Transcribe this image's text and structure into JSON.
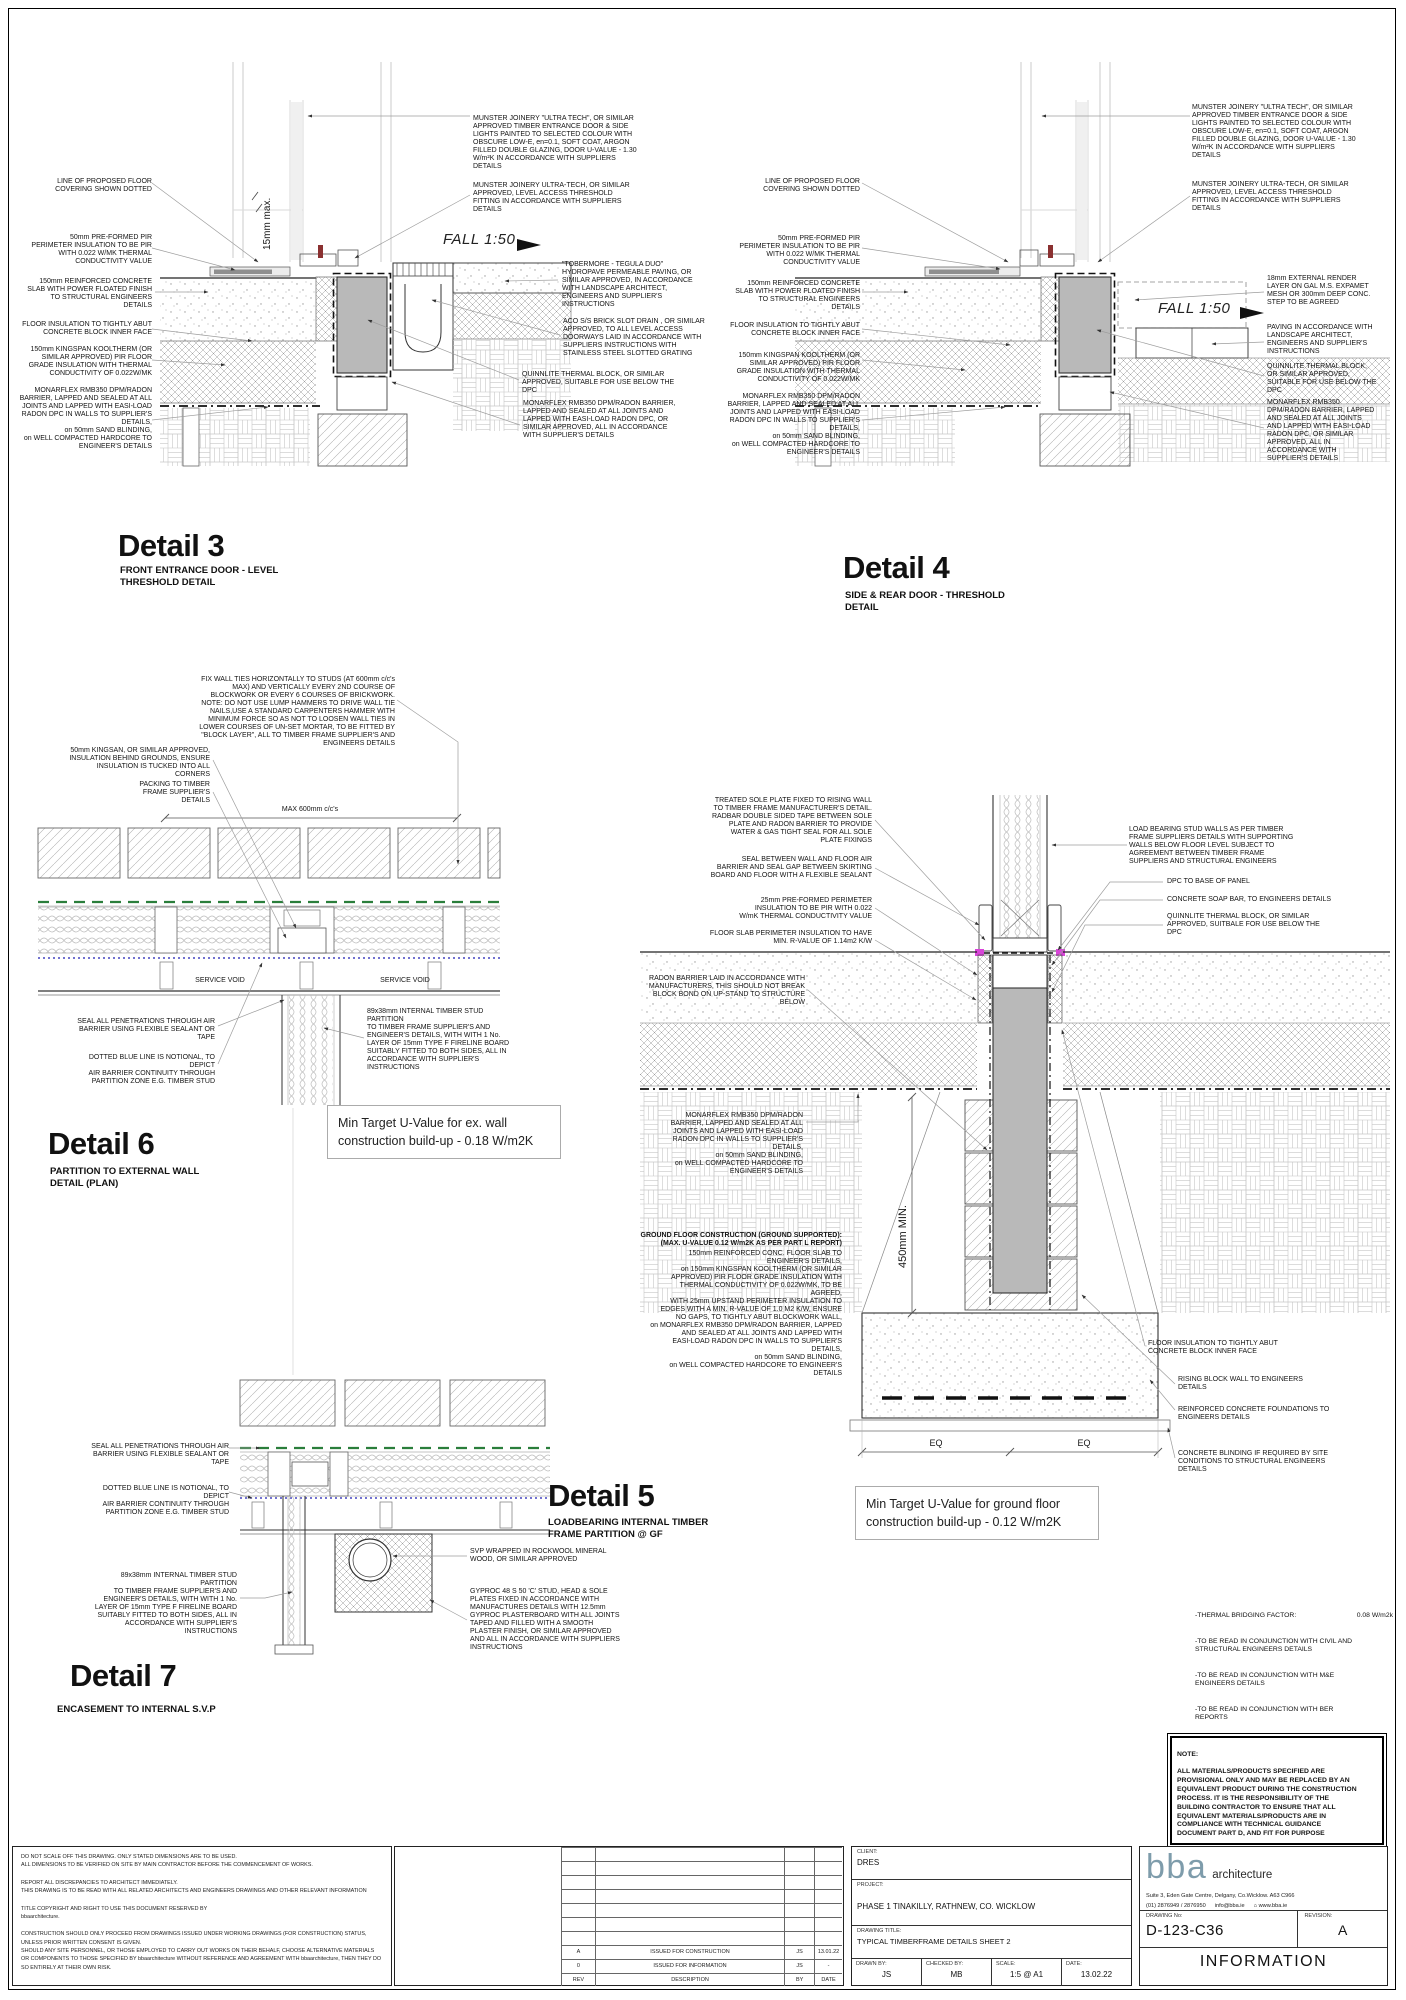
{
  "colors": {
    "air_barrier_green": "#2a7e3b",
    "air_barrier_blue": "#4343c0",
    "dpc_magenta": "#d944d9",
    "block_grey": "#b9b9b9",
    "logo_teal": "#7e9cab"
  },
  "details": {
    "d3": {
      "title": "Detail 3",
      "subtitle": "FRONT ENTRANCE DOOR - LEVEL\nTHRESHOLD DETAIL",
      "fall": "FALL 1:50",
      "dim15": "15mm max.",
      "left": [
        "LINE OF PROPOSED FLOOR\nCOVERING SHOWN DOTTED",
        "50mm PRE-FORMED  PIR\nPERIMETER INSULATION TO BE PIR\nWITH 0.022 W/MK THERMAL\nCONDUCTIVITY VALUE",
        "150mm REINFORCED CONCRETE\nSLAB WITH POWER FLOATED FINISH\nTO STRUCTURAL ENGINEERS\nDETAILS",
        "FLOOR INSULATION TO TIGHTLY ABUT\nCONCRETE BLOCK INNER FACE",
        "150mm KINGSPAN KOOLTHERM (OR\nSIMILAR APPROVED) PIR FLOOR\nGRADE INSULATION WITH THERMAL\nCONDUCTIVITY OF 0.022W/MK",
        "MONARFLEX RMB350 DPM/RADON\nBARRIER, LAPPED AND SEALED AT ALL\nJOINTS AND LAPPED WITH EASI-LOAD\nRADON DPC IN WALLS TO SUPPLIER'S\nDETAILS,\non 50mm SAND BLINDING,\non WELL COMPACTED HARDCORE TO\nENGINEER'S DETAILS"
      ],
      "right": [
        "MUNSTER JOINERY \"ULTRA TECH\", OR SIMILAR\nAPPROVED TIMBER ENTRANCE DOOR & SIDE\nLIGHTS PAINTED TO SELECTED COLOUR WITH\nOBSCURE LOW-E, en=0.1, SOFT COAT, ARGON\nFILLED DOUBLE GLAZING, DOOR U-VALUE - 1.30\nW/m²K IN ACCORDANCE WITH SUPPLIERS\nDETAILS",
        "MUNSTER JOINERY ULTRA-TECH, OR SIMILAR\nAPPROVED, LEVEL ACCESS THRESHOLD\nFITTING IN ACCORDANCE WITH SUPPLIERS\nDETAILS",
        "\"TOBERMORE - TEGULA DUO\"\nHYDROPAVE PERMEABLE PAVING, OR\nSIMILAR APPROVED, IN ACCORDANCE\nWITH LANDSCAPE ARCHITECT,\nENGINEERS AND SUPPLIER'S\nINSTRUCTIONS",
        "ACO S/S BRICK SLOT DRAIN , OR SIMILAR\nAPPROVED, TO ALL LEVEL ACCESS\nDOORWAYS LAID IN ACCORDANCE WITH\nSUPPLIERS INSTRUCTIONS WITH\nSTAINLESS STEEL SLOTTED GRATING",
        "QUINNLITE THERMAL BLOCK, OR SIMILAR\nAPPROVED, SUITABLE FOR USE BELOW THE\nDPC",
        "MONARFLEX RMB350 DPM/RADON BARRIER,\nLAPPED AND SEALED AT ALL JOINTS AND\nLAPPED WITH EASI-LOAD RADON DPC, OR\nSIMILAR APPROVED, ALL IN ACCORDANCE\nWITH SUPPLIER'S DETAILS"
      ]
    },
    "d4": {
      "title": "Detail 4",
      "subtitle": "SIDE & REAR DOOR - THRESHOLD\nDETAIL",
      "fall": "FALL 1:50",
      "left": [
        "LINE OF PROPOSED FLOOR\nCOVERING SHOWN DOTTED",
        "50mm PRE-FORMED  PIR\nPERIMETER INSULATION TO BE PIR\nWITH 0.022 W/MK THERMAL\nCONDUCTIVITY VALUE",
        "150mm REINFORCED CONCRETE\nSLAB WITH POWER FLOATED FINISH\nTO STRUCTURAL ENGINEERS\nDETAILS",
        "FLOOR INSULATION TO TIGHTLY ABUT\nCONCRETE BLOCK INNER FACE",
        "150mm KINGSPAN KOOLTHERM (OR\nSIMILAR APPROVED) PIR FLOOR\nGRADE INSULATION WITH THERMAL\nCONDUCTIVITY OF 0.022W/MK",
        "MONARFLEX RMB350 DPM/RADON\nBARRIER, LAPPED AND SEALED AT ALL\nJOINTS AND LAPPED WITH EASI-LOAD\nRADON DPC IN WALLS TO SUPPLIER'S\nDETAILS,\non 50mm SAND BLINDING,\non WELL COMPACTED HARDCORE TO\nENGINEER'S DETAILS"
      ],
      "right": [
        "MUNSTER JOINERY \"ULTRA TECH\", OR SIMILAR\nAPPROVED TIMBER ENTRANCE DOOR & SIDE\nLIGHTS PAINTED TO SELECTED COLOUR WITH\nOBSCURE LOW-E, en=0.1, SOFT COAT, ARGON\nFILLED DOUBLE GLAZING, DOOR U-VALUE - 1.30\nW/m²K IN ACCORDANCE WITH SUPPLIERS\nDETAILS",
        "MUNSTER JOINERY ULTRA-TECH, OR SIMILAR\nAPPROVED, LEVEL ACCESS THRESHOLD\nFITTING IN ACCORDANCE WITH SUPPLIERS\nDETAILS",
        "18mm EXTERNAL RENDER\nLAYER ON GAL M.S. EXPAMET\nMESH OR 300mm DEEP CONC.\nSTEP TO BE AGREED",
        "PAVING IN ACCORDANCE WITH\nLANDSCAPE ARCHITECT,\nENGINEERS AND SUPPLIER'S\nINSTRUCTIONS",
        "QUINNLITE THERMAL BLOCK,\nOR SIMILAR APPROVED,\nSUITABLE FOR USE BELOW THE\nDPC",
        "MONARFLEX RMB350\nDPM/RADON BARRIER, LAPPED\nAND SEALED AT ALL JOINTS\nAND LAPPED WITH EASI-LOAD\nRADON DPC, OR SIMILAR\nAPPROVED, ALL IN\nACCORDANCE WITH\nSUPPLIER'S DETAILS"
      ]
    },
    "d6": {
      "title": "Detail 6",
      "subtitle": "PARTITION TO EXTERNAL WALL\nDETAIL (PLAN)",
      "uvalue": "Min Target U-Value for ex. wall\nconstruction build-up - 0.18 W/m2K",
      "dim600": "MAX 600mm c/c's",
      "service": "SERVICE VOID",
      "ann": [
        "FIX WALL TIES HORIZONTALLY TO STUDS (AT 600mm c/c's\nMAX) AND VERTICALLY EVERY 2ND COURSE OF\nBLOCKWORK OR EVERY 6 COURSES OF BRICKWORK.\nNOTE: DO NOT USE LUMP HAMMERS TO DRIVE WALL TIE\nNAILS,USE A STANDARD CARPENTERS HAMMER WITH\nMINIMUM FORCE SO AS NOT TO LOOSEN WALL TIES IN\nLOWER COURSES OF UN-SET MORTAR, TO BE FITTED BY\n\"BLOCK LAYER\", ALL TO TIMBER FRAME SUPPLIER'S AND\nENGINEERS DETAILS",
        "50mm KINGSAN, OR SIMILAR APPROVED,\nINSULATION BEHIND GROUNDS, ENSURE\nINSULATION IS TUCKED INTO ALL CORNERS",
        "PACKING TO TIMBER\nFRAME SUPPLIER'S\nDETAILS",
        "SEAL ALL PENETRATIONS THROUGH AIR\nBARRIER USING FLEXIBLE SEALANT OR TAPE",
        "DOTTED BLUE LINE IS NOTIONAL, TO DEPICT\nAIR BARRIER CONTINUITY THROUGH\nPARTITION ZONE E.G. TIMBER STUD",
        "89x38mm INTERNAL TIMBER STUD PARTITION\nTO TIMBER FRAME SUPPLIER'S AND\nENGINEER'S DETAILS, WITH WITH 1 No.\nLAYER OF 15mm TYPE F FIRELINE BOARD\nSUITABLY FITTED TO BOTH SIDES, ALL IN\nACCORDANCE WITH SUPPLIER'S\nINSTRUCTIONS"
      ]
    },
    "d5": {
      "title": "Detail 5",
      "subtitle": "LOADBEARING INTERNAL TIMBER\nFRAME PARTITION @ GF",
      "uvalue": "Min Target U-Value for ground floor\nconstruction build-up - 0.12 W/m2K",
      "dim450": "450mm MIN.",
      "eq": "EQ",
      "left": [
        "TREATED SOLE PLATE FIXED TO RISING WALL\nTO TIMBER FRAME MANUFACTURER'S DETAIL.\nRADBAR DOUBLE SIDED TAPE BETWEEN SOLE\nPLATE AND RADON BARRIER TO PROVIDE\nWATER & GAS TIGHT SEAL FOR ALL SOLE\nPLATE FIXINGS",
        "SEAL BETWEEN WALL AND FLOOR AIR\nBARRIER AND SEAL GAP BETWEEN SKIRTING\nBOARD AND FLOOR WITH A FLEXIBLE SEALANT",
        "25mm PRE-FORMED PERIMETER\nINSULATION TO BE PIR WITH 0.022\nW/mK THERMAL CONDUCTIVITY VALUE",
        "FLOOR SLAB PERIMETER INSULATION TO HAVE\nMIN. R-VALUE OF 1.14m2 K/W",
        "RADON BARRIER LAID IN ACCORDANCE WITH\nMANUFACTURERS, THIS SHOULD NOT BREAK\nBLOCK BOND ON UP-STAND TO STRUCTURE\nBELOW",
        "MONARFLEX RMB350 DPM/RADON\nBARRIER, LAPPED AND SEALED AT ALL\nJOINTS AND LAPPED WITH EASI-LOAD\nRADON DPC IN WALLS TO SUPPLIER'S\nDETAILS,\non 50mm SAND BLINDING,\non WELL COMPACTED HARDCORE TO\nENGINEER'S DETAILS"
      ],
      "ground_header": "GROUND FLOOR CONSTRUCTION (GROUND SUPPORTED):\n(MAX. U-VALUE 0.12 W/m2K AS PER PART L REPORT)",
      "ground_body": "150mm REINFORCED CONC. FLOOR SLAB TO\nENGINEER'S DETAILS,\non 150mm KINGSPAN KOOLTHERM (OR SIMILAR\nAPPROVED) PIR FLOOR GRADE INSULATION WITH\nTHERMAL CONDUCTIVITY OF 0.022W/MK, TO BE\nAGREED,\nWITH 25mm UPSTAND PERIMETER INSULATION TO\nEDGES WITH A MIN. R-VALUE OF 1.0 M2 K/W, ENSURE\nNO GAPS, TO TIGHTLY ABUT BLOCKWORK WALL,\non MONARFLEX RMB350 DPM/RADON BARRIER, LAPPED\nAND SEALED AT ALL JOINTS AND LAPPED WITH\nEASI-LOAD RADON DPC IN WALLS TO SUPPLIER'S\nDETAILS,\non 50mm SAND BLINDING,\non WELL COMPACTED HARDCORE TO ENGINEER'S\nDETAILS",
      "right": [
        "LOAD BEARING STUD WALLS AS PER TIMBER\nFRAME SUPPLIERS DETAILS WITH SUPPORTING\nWALLS BELOW FLOOR LEVEL SUBJECT TO\nAGREEMENT BETWEEN TIMBER FRAME\nSUPPLIERS AND STRUCTURAL ENGINEERS",
        "DPC TO BASE OF PANEL",
        "CONCRETE SOAP BAR, TO ENGINEERS DETAILS",
        "QUINNLITE THERMAL BLOCK, OR SIMILAR\nAPPROVED, SUITBALE FOR USE BELOW THE\nDPC",
        "FLOOR INSULATION TO TIGHTLY ABUT\nCONCRETE BLOCK INNER FACE",
        "RISING BLOCK WALL TO ENGINEERS\nDETAILS",
        "REINFORCED CONCRETE FOUNDATIONS TO\nENGINEERS DETAILS",
        "CONCRETE BLINDING IF REQUIRED BY SITE\nCONDITIONS TO STRUCTURAL ENGINEERS\nDETAILS"
      ]
    },
    "d7": {
      "title": "Detail 7",
      "subtitle": "ENCASEMENT TO INTERNAL S.V.P",
      "ann": [
        "SEAL ALL PENETRATIONS THROUGH AIR\nBARRIER USING FLEXIBLE SEALANT OR TAPE",
        "DOTTED BLUE LINE IS NOTIONAL, TO DEPICT\nAIR BARRIER CONTINUITY THROUGH\nPARTITION ZONE E.G. TIMBER STUD",
        "89x38mm INTERNAL TIMBER STUD PARTITION\nTO TIMBER FRAME SUPPLIER'S AND\nENGINEER'S DETAILS, WITH WITH 1 No.\nLAYER OF 15mm TYPE F FIRELINE BOARD\nSUITABLY FITTED TO BOTH SIDES, ALL IN\nACCORDANCE WITH SUPPLIER'S\nINSTRUCTIONS",
        "SVP WRAPPED IN ROCKWOOL MINERAL\nWOOD, OR SIMILAR APPROVED",
        "GYPROC 48 S 50 'C' STUD, HEAD & SOLE\nPLATES FIXED IN ACCORDANCE WITH\nMANUFACTURES DETAILS WITH 12.5mm\nGYPROC PLASTERBOARD WITH ALL JOINTS\nTAPED AND FILLED WITH A SMOOTH\nPLASTER FINISH, OR SIMILAR APPROVED\nAND ALL IN ACCORDANCE WITH SUPPLIERS\nINSTRUCTIONS"
      ]
    }
  },
  "notes": {
    "thermal_label": "-THERMAL BRIDGING FACTOR:",
    "thermal_value": "0.08 W/m2k",
    "items": [
      "-TO BE READ IN CONJUNCTION WITH CIVIL AND\nSTRUCTURAL ENGINEERS DETAILS",
      "-TO BE READ IN CONJUNCTION WITH M&E\nENGINEERS DETAILS",
      "-TO BE READ IN CONJUNCTION WITH BER\nREPORTS"
    ],
    "note_title": "NOTE:",
    "note_body": " ALL MATERIALS/PRODUCTS SPECIFIED ARE\nPROVISIONAL ONLY AND MAY BE REPLACED BY AN\nEQUIVALENT PRODUCT DURING THE CONSTRUCTION\nPROCESS. IT IS THE RESPONSIBILITY OF THE\nBUILDING CONTRACTOR TO ENSURE THAT ALL\nEQUIVALENT MATERIALS/PRODUCTS ARE IN\nCOMPLIANCE WITH TECHNICAL GUIDANCE\nDOCUMENT PART D, AND FIT FOR PURPOSE"
  },
  "titleblock": {
    "disclaimer1": "DO NOT SCALE OFF THIS DRAWING. ONLY STATED DIMENSIONS ARE TO BE USED.\nALL DIMENSIONS TO BE VERIFIED ON SITE BY MAIN CONTRACTOR BEFORE THE COMMENCEMENT OF WORKS.",
    "disclaimer2": "REPORT ALL DISCREPANCIES TO ARCHITECT IMMEDIATELY.\nTHIS DRAWING IS TO BE READ WITH ALL RELATED ARCHITECTS AND ENGINEERS  DRAWINGS AND OTHER RELEVANT INFORMATION",
    "disclaimer3": "TITLE COPYRIGHT AND RIGHT TO USE THIS DOCUMENT RESERVED BY\nbbaarchitecture.",
    "disclaimer4": "CONSTRUCTION SHOULD ONLY PROCEED FROM DRAWINGS ISSUED UNDER WORKING DRAWINGS (FOR CONSTRUCTION) STATUS, UNLESS PRIOR WRITTEN CONSENT IS GIVEN.\nSHOULD ANY SITE PERSONNEL, OR THOSE EMPLOYED TO CARRY OUT WORKS ON THEIR BEHALF, CHOOSE ALTERNATIVE MATERIALS OR COMPONENTS TO THOSE SPECIFIED BY bbaarchitecture WITHOUT REFERENCE AND AGREEMENT WITH bbaarchitecture, THEN THEY DO SO ENTIRELY AT THEIR OWN RISK.",
    "revisions": {
      "header": {
        "rev": "REV",
        "desc": "DESCRIPTION",
        "by": "BY",
        "date": "DATE"
      },
      "rows": [
        {
          "rev": "A",
          "desc": "ISSUED FOR CONSTRUCTION",
          "by": "JS",
          "date": "13.01.22"
        },
        {
          "rev": "0",
          "desc": "ISSUED FOR INFORMATION",
          "by": "JS",
          "date": "-"
        }
      ]
    },
    "client_label": "CLIENT:",
    "client": "DRES",
    "project_label": "PROJECT:",
    "project": "PHASE 1 TINAKILLY, RATHNEW, CO. WICKLOW",
    "title_label": "DRAWING TITLE:",
    "drawing_title": "TYPICAL TIMBERFRAME DETAILS SHEET 2",
    "drawn_label": "DRAWN BY:",
    "drawn": "JS",
    "checked_label": "CHECKED BY:",
    "checked": "MB",
    "scale_label": "SCALE:",
    "scale": "1:5 @ A1",
    "date_label": "DATE:",
    "date": "13.02.22",
    "logo_bba": "bba",
    "logo_arch": "architecture",
    "address": "Suite 3, Eden Gate Centre, Delgany, Co.Wicklow. A63 C966",
    "phone": "(01) 2876949 / 2876950",
    "email": "info@bba.ie",
    "web": "www.bba.ie",
    "drawingno_label": "DRAWING No:",
    "drawing_no": "D-123-C36",
    "revision_label": "REVISION:",
    "revision": "A",
    "status": "INFORMATION"
  }
}
